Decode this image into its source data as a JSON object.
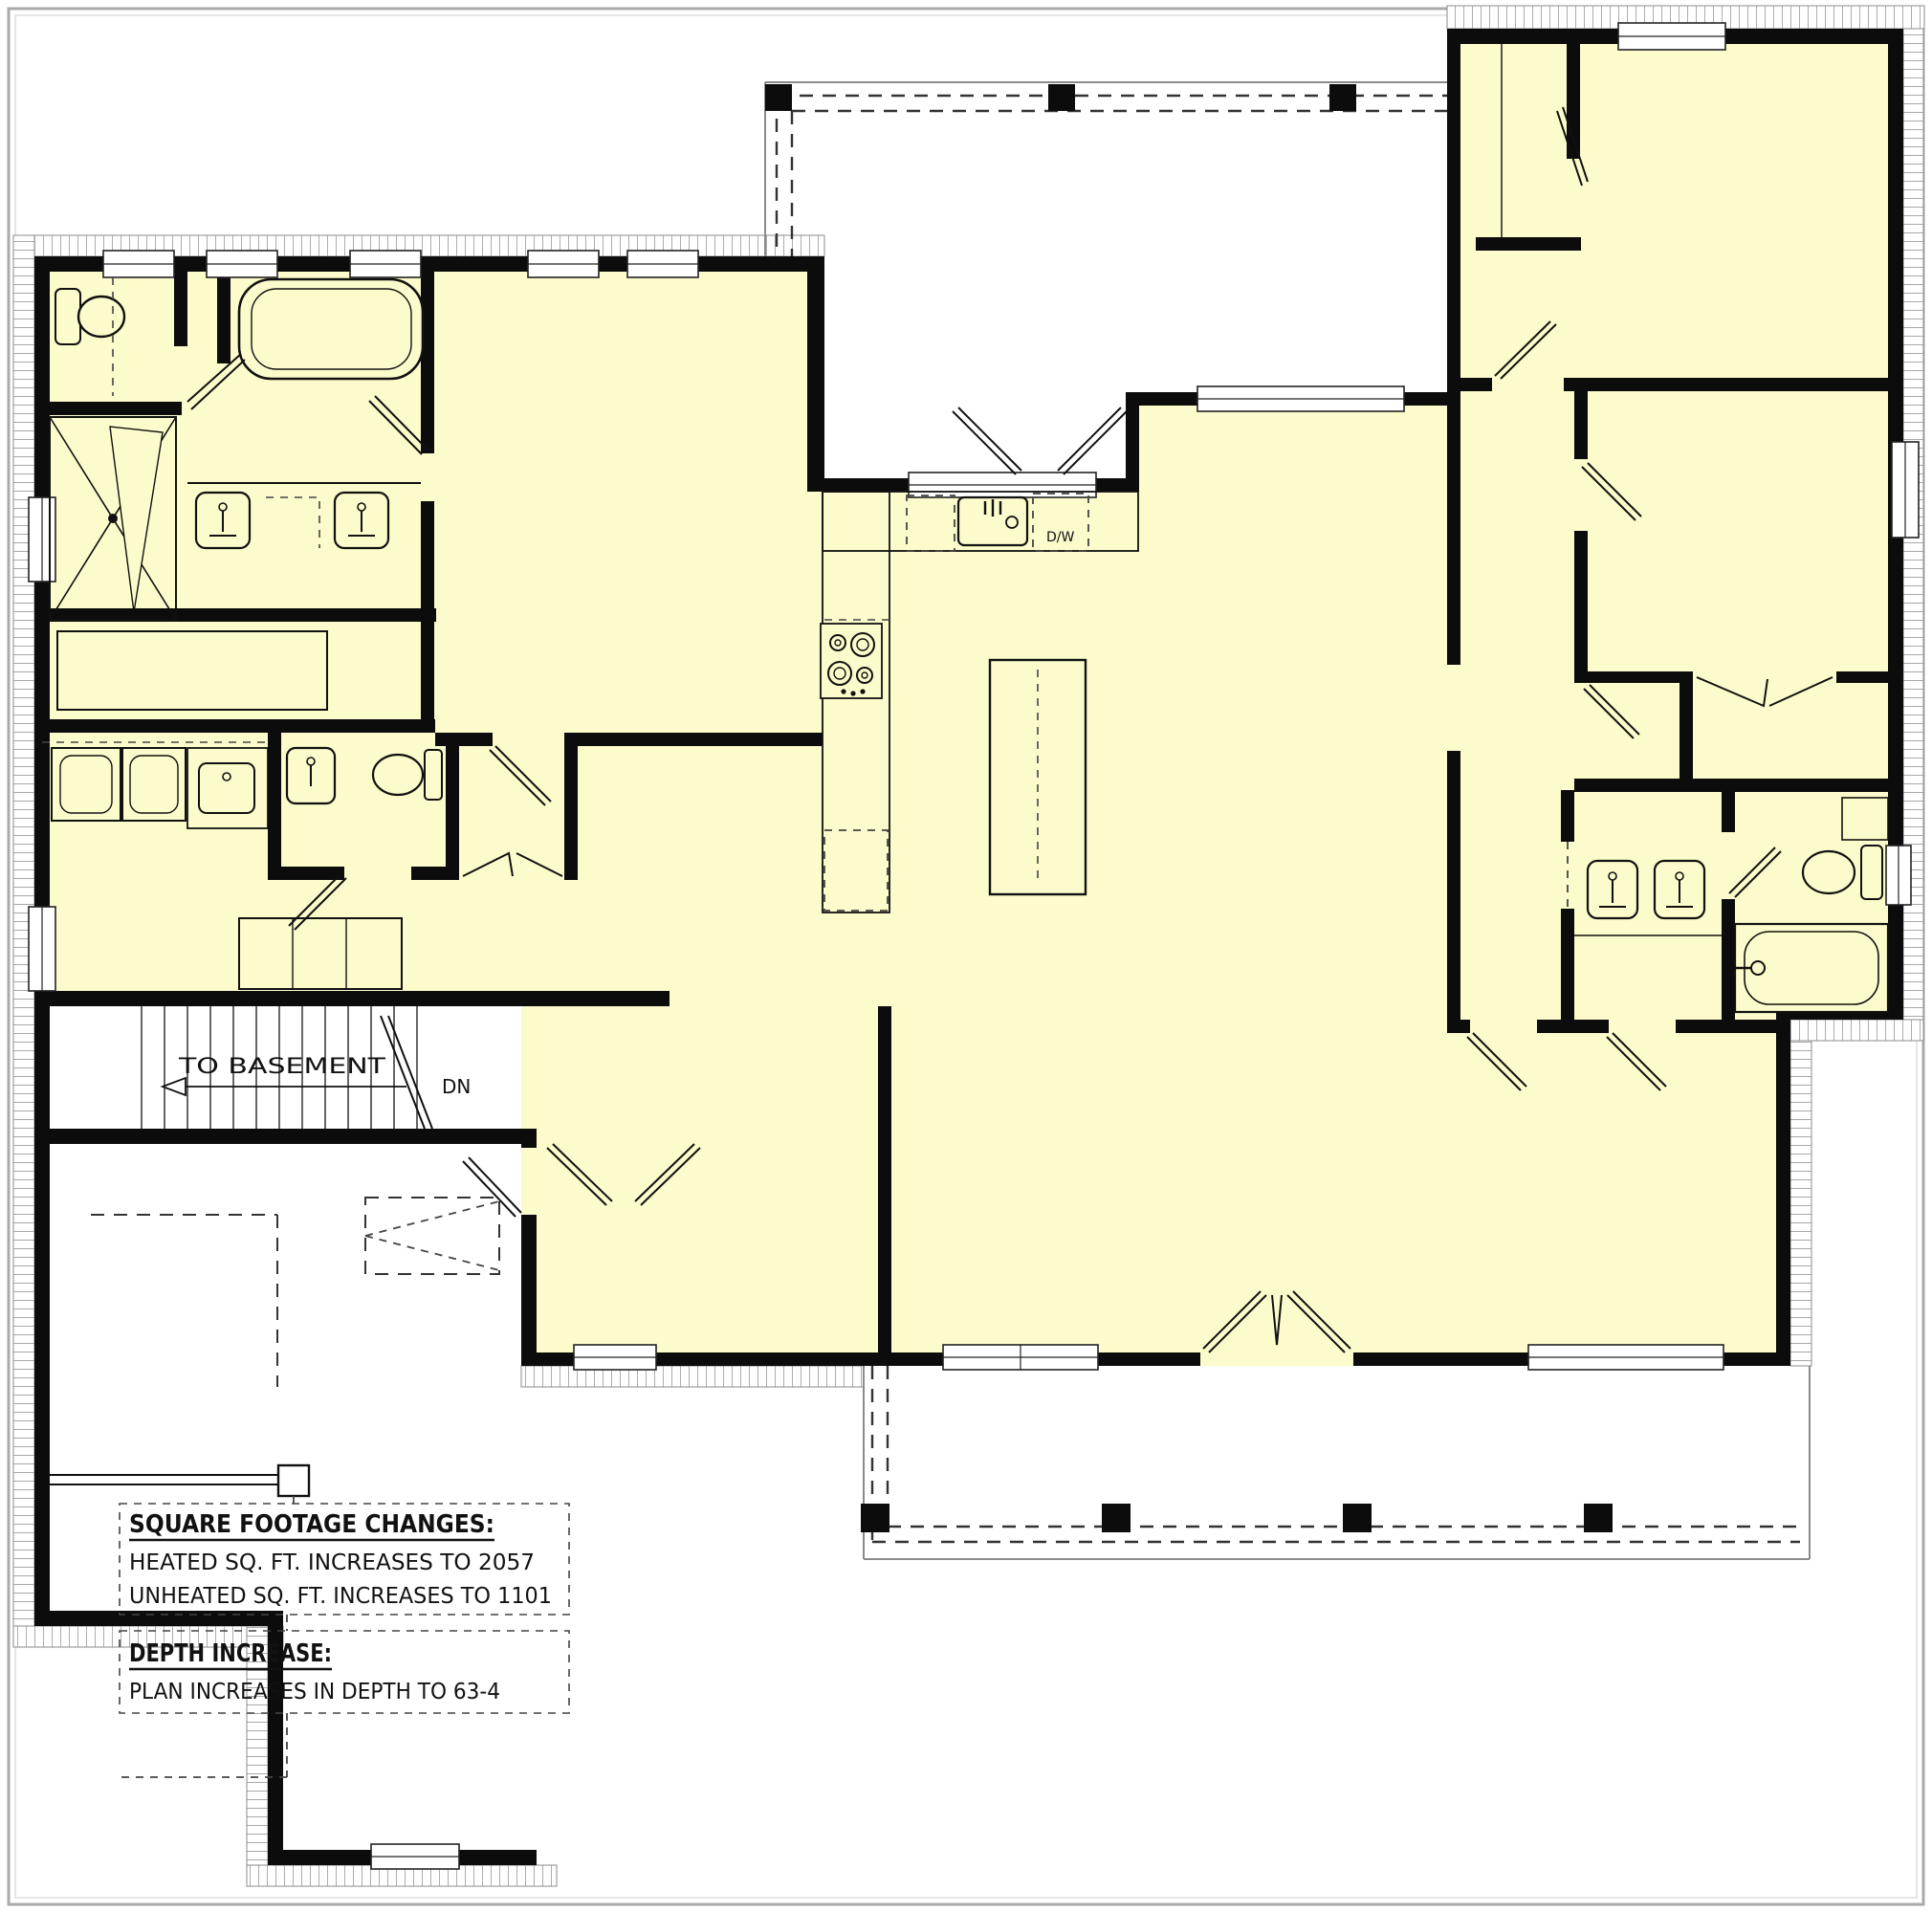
{
  "plan": {
    "stairs": {
      "to_basement": "TO BASEMENT",
      "down": "DN"
    },
    "kitchen": {
      "dishwasher": "D/W"
    },
    "notes": {
      "sqft_title": "SQUARE FOOTAGE CHANGES:",
      "heated": "HEATED SQ. FT. INCREASES TO 2057",
      "unheated": "UNHEATED SQ. FT. INCREASES TO 1101",
      "depth_title": "DEPTH INCREASE:",
      "depth": "PLAN INCREASES IN DEPTH TO 63-4"
    },
    "colors": {
      "floor": "#FCFBCB",
      "wall": "#0C0C0C",
      "hatch": "#8B8B8B",
      "porch_outline": "#8A8A8A",
      "paper": "#FFFFFF",
      "frame": "#AAAAAA"
    }
  }
}
